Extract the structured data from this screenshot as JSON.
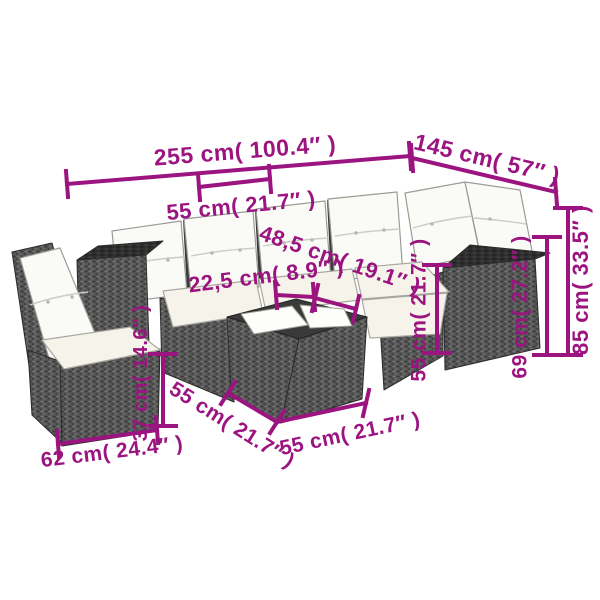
{
  "accent_color": "#9b1480",
  "furniture": {
    "pieces": [
      "corner-sofa",
      "lounge-chair",
      "coffee-table"
    ],
    "colors": {
      "rattan": "#555555",
      "rattan_top": "#2f2f2f",
      "cushion": "#fafaf6",
      "seat_cushion": "#f6f4ea"
    }
  },
  "dimensions": [
    {
      "id": "sofa-total-length",
      "label": "255 cm( 100.4″ )"
    },
    {
      "id": "right-section-length",
      "label": "145 cm( 57″ )"
    },
    {
      "id": "seat-width-top",
      "label": "55 cm( 21.7″ )"
    },
    {
      "id": "seat-depth",
      "label": "48,5 cm( 19.1″ )"
    },
    {
      "id": "armrest-width",
      "label": "22,5 cm( 8.9″ )"
    },
    {
      "id": "seat-height-right",
      "label": "55 cm( 21.7″ )"
    },
    {
      "id": "armrest-height",
      "label": "69 cm( 27.2″ )"
    },
    {
      "id": "back-height",
      "label": "85 cm( 33.5″ )"
    },
    {
      "id": "chair-seat-height",
      "label": "37 cm( 14.6″ )"
    },
    {
      "id": "chair-width",
      "label": "62 cm( 24.4″ )"
    },
    {
      "id": "table-depth",
      "label": "55 cm( 21.7″ )"
    },
    {
      "id": "table-width",
      "label": "55 cm( 21.7″ )"
    }
  ]
}
